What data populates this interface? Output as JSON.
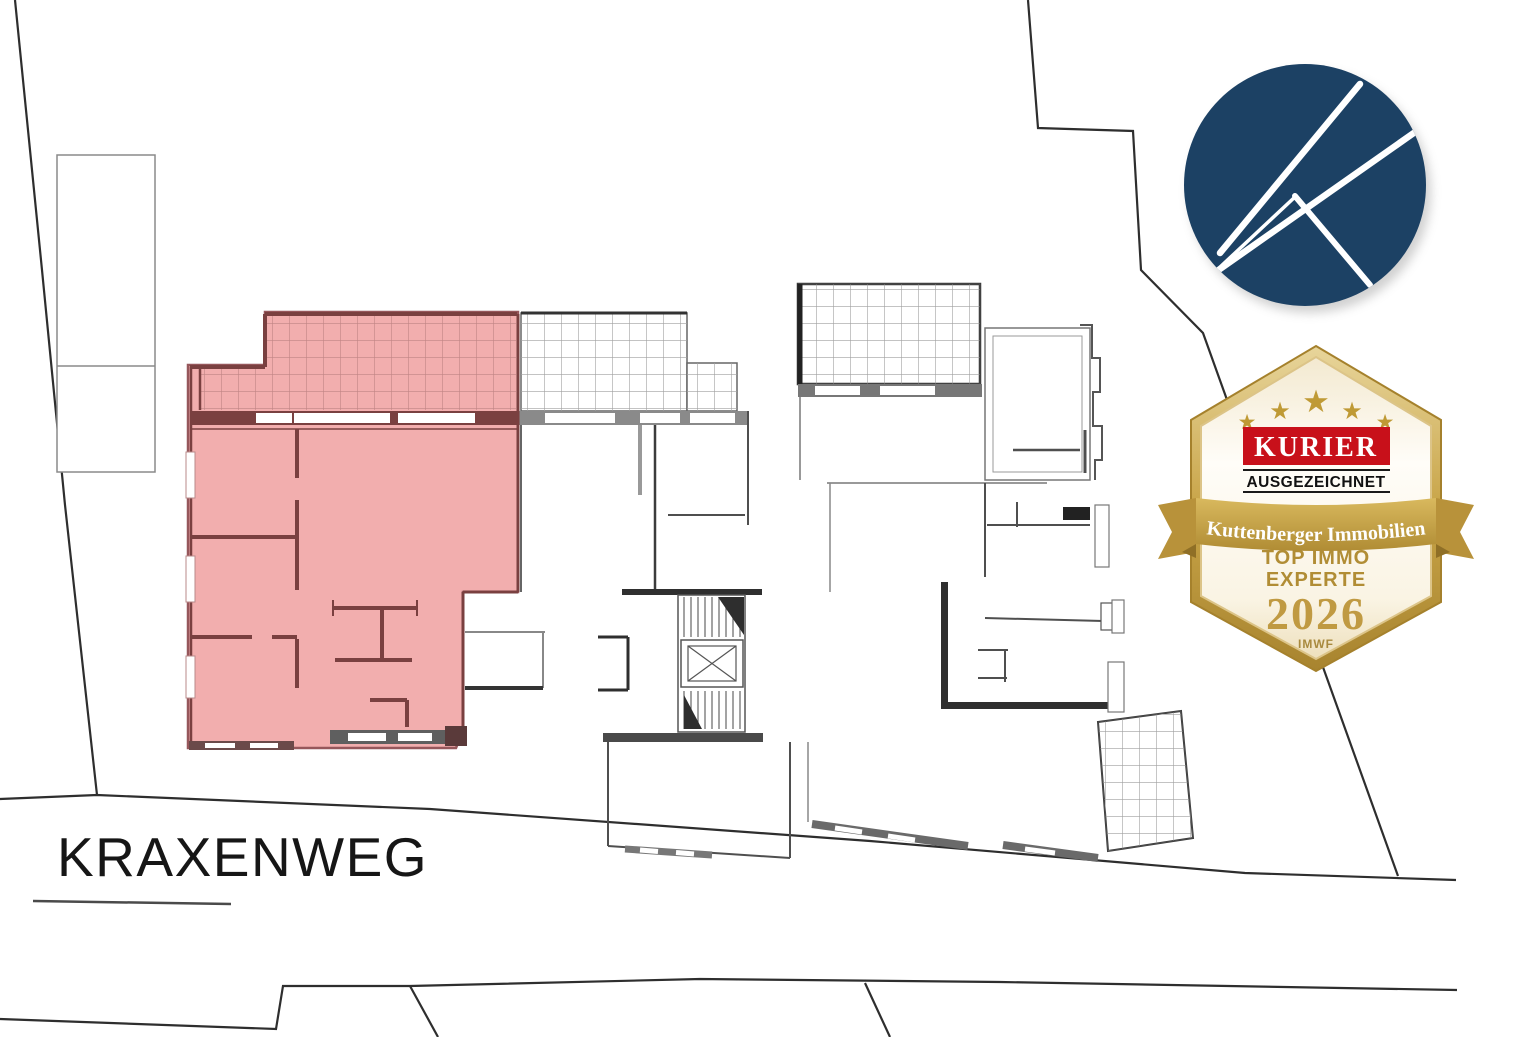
{
  "page": {
    "background_color": "#ffffff"
  },
  "site_plan": {
    "street_label": "KRAXENWEG",
    "highlight_color": "#f2aeae",
    "highlight_wall_color": "#7a4040",
    "plan_line_color": "#4a4a4a",
    "boundary_line_color": "#2e2e2e"
  },
  "logo": {
    "icon": "k-monogram-icon",
    "letter": "K",
    "circle_color": "#1c4164",
    "mark_color": "#ffffff"
  },
  "badge": {
    "publisher": "KURIER",
    "award_label": "AUSGEZEICHNET",
    "company": "Kuttenberger Immobilien",
    "title_line1": "TOP IMMO",
    "title_line2": "EXPERTE",
    "year": "2026",
    "institute": "IMWF",
    "star_count": 5,
    "gold_color": "#c49a3f",
    "red_color": "#c8101a"
  }
}
